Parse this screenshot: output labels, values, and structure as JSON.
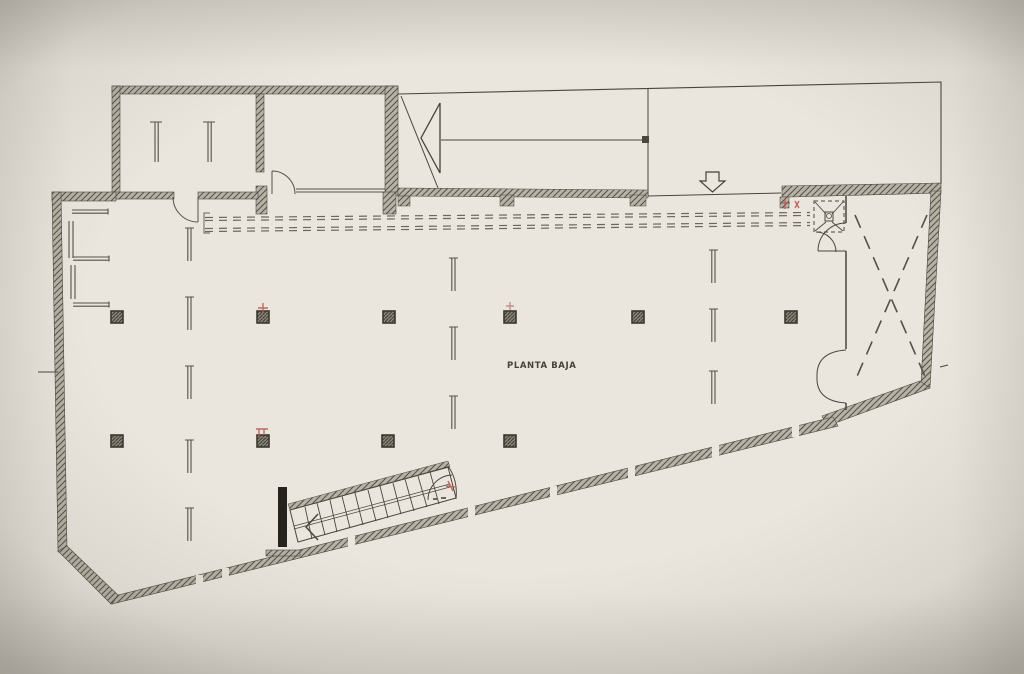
{
  "plan": {
    "title": "PLANTA BAJA",
    "colors": {
      "paper": "#eae6de",
      "ink": "#45423a",
      "wall_hatch": "#57534a",
      "annotation_red": "#bb5a52"
    }
  }
}
